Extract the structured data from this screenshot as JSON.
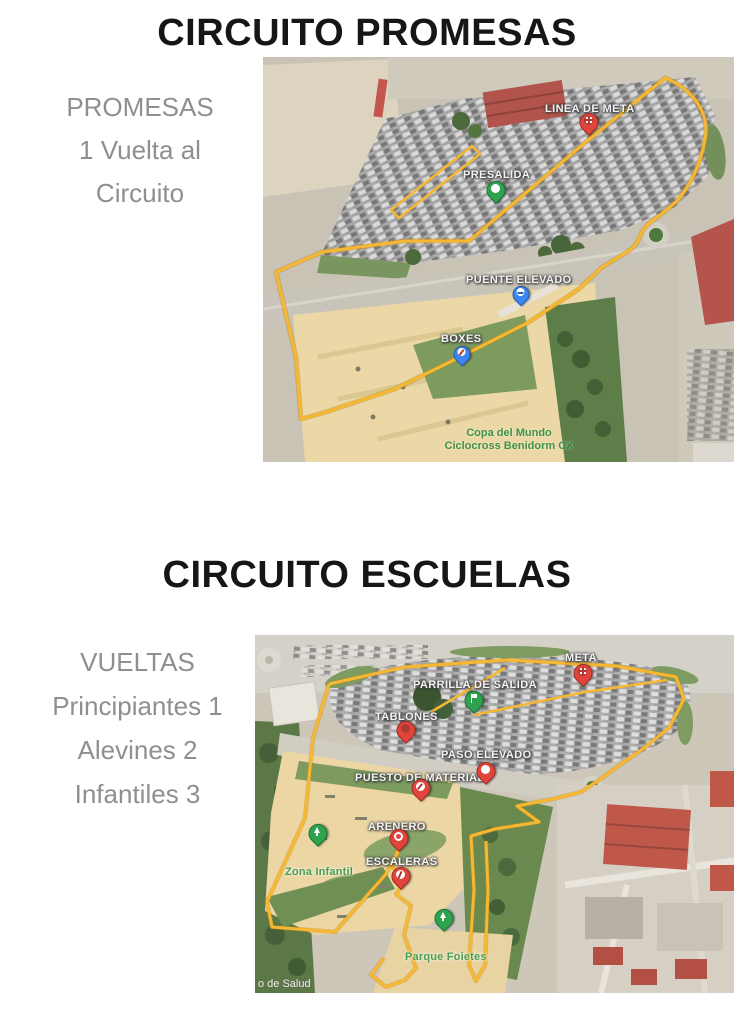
{
  "promesas": {
    "title": "CIRCUITO PROMESAS",
    "side_lines": [
      "PROMESAS",
      "1 Vuelta al",
      "Circuito"
    ],
    "labels": {
      "linea_de_meta": "LINEA DE META",
      "presalida": "PRESALIDA",
      "puente_elevado": "PUENTE ELEVADO",
      "boxes": "BOXES"
    },
    "watermark": [
      "Copa del Mundo",
      "Ciclocross Benidorm CX"
    ]
  },
  "escuelas": {
    "title": "CIRCUITO ESCUELAS",
    "side_lines": [
      "VUELTAS",
      "Principiantes 1",
      "Alevines 2",
      "Infantiles 3"
    ],
    "labels": {
      "meta": "META",
      "parrilla_de_salida": "PARRILLA DE SALIDA",
      "tablones": "TABLONES",
      "paso_elevado": "PASO ELEVADO",
      "puesto_de_material": "PUESTO DE MATERIAL",
      "arenero": "ARENERO",
      "escaleras": "ESCALERAS",
      "zona_infantil": "Zona Infantil",
      "parque_foietes": "Parque Foietes",
      "centro_salud": "o de Salud"
    }
  },
  "colors": {
    "route_yellow": "#f6b733",
    "marker_red": "#e0443a",
    "marker_green": "#2fa24f",
    "marker_blue": "#3d85f2",
    "title_text": "#161616",
    "side_text": "#8f8f8f",
    "watermark_green": "#2f8a3a"
  }
}
